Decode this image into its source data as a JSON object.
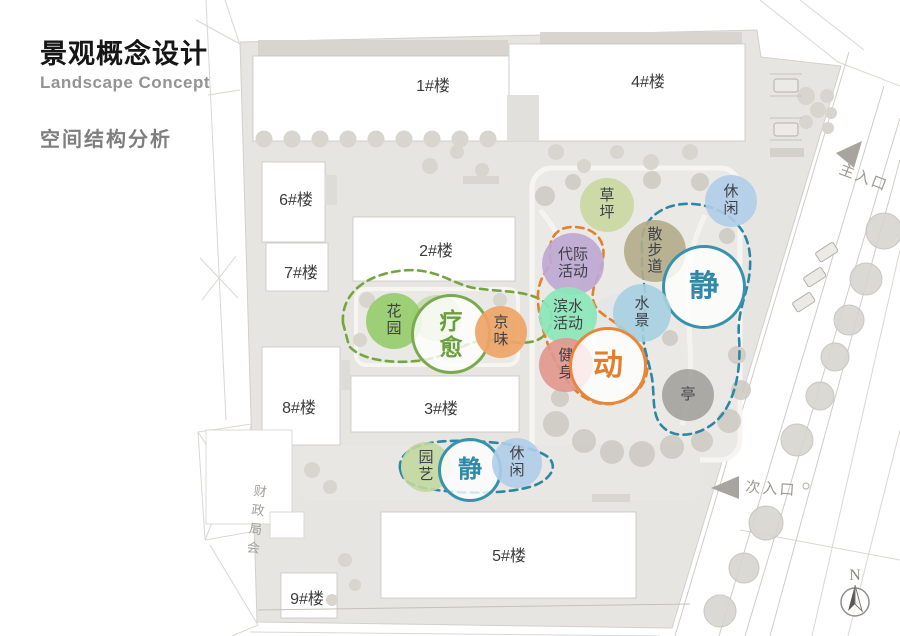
{
  "header": {
    "title": "景观概念设计",
    "subtitle": "Landscape Concept",
    "section": "空间结构分析"
  },
  "buildings": [
    {
      "label": "1#楼"
    },
    {
      "label": "2#楼"
    },
    {
      "label": "3#楼"
    },
    {
      "label": "4#楼"
    },
    {
      "label": "5#楼"
    },
    {
      "label": "6#楼"
    },
    {
      "label": "7#楼"
    },
    {
      "label": "8#楼"
    },
    {
      "label": "9#楼"
    }
  ],
  "bubbles": [
    {
      "name": "lawn",
      "lines": [
        "草",
        "坪"
      ],
      "color": "#cad8a3"
    },
    {
      "name": "leisure-upper",
      "lines": [
        "休",
        "闲"
      ],
      "color": "#b0cde9"
    },
    {
      "name": "walking-path",
      "lines": [
        "散",
        "步",
        "道"
      ],
      "color": "#b2ac89"
    },
    {
      "name": "quiet-upper",
      "lines": [
        "静"
      ],
      "color": "#3793ad"
    },
    {
      "name": "intergenerational-activity",
      "lines": [
        "代际",
        "活动"
      ],
      "color": "#bea8d4"
    },
    {
      "name": "waterfront-activity",
      "lines": [
        "滨水",
        "活动"
      ],
      "color": "#8be6ba"
    },
    {
      "name": "water-feature",
      "lines": [
        "水",
        "景"
      ],
      "color": "#a6d0e2"
    },
    {
      "name": "fitness",
      "lines": [
        "健",
        "身"
      ],
      "color": "#e2978f"
    },
    {
      "name": "active",
      "lines": [
        "动"
      ],
      "color": "#e8873a"
    },
    {
      "name": "pavilion",
      "lines": [
        "亭"
      ],
      "color": "#a09d98"
    },
    {
      "name": "garden",
      "lines": [
        "花",
        "园"
      ],
      "color": "#96cc6e"
    },
    {
      "name": "healing",
      "lines": [
        "疗",
        "愈"
      ],
      "color": "#6ca23f"
    },
    {
      "name": "beijing-flavor",
      "lines": [
        "京",
        "味"
      ],
      "color": "#eea467"
    },
    {
      "name": "horticulture",
      "lines": [
        "园",
        "艺"
      ],
      "color": "#c1d89e"
    },
    {
      "name": "quiet-lower",
      "lines": [
        "静"
      ],
      "color": "#3793ad"
    },
    {
      "name": "leisure-lower",
      "lines": [
        "休",
        "闲"
      ],
      "color": "#b5d1ea"
    }
  ],
  "zone_outline_colors": {
    "healing": "#74a540",
    "active": "#e2802d",
    "quiet": "#2b87a3"
  },
  "entrances": {
    "main": "主入口",
    "secondary": "次入口"
  },
  "compass": {
    "north": "N"
  },
  "adjacent_parcel": "财政局会"
}
